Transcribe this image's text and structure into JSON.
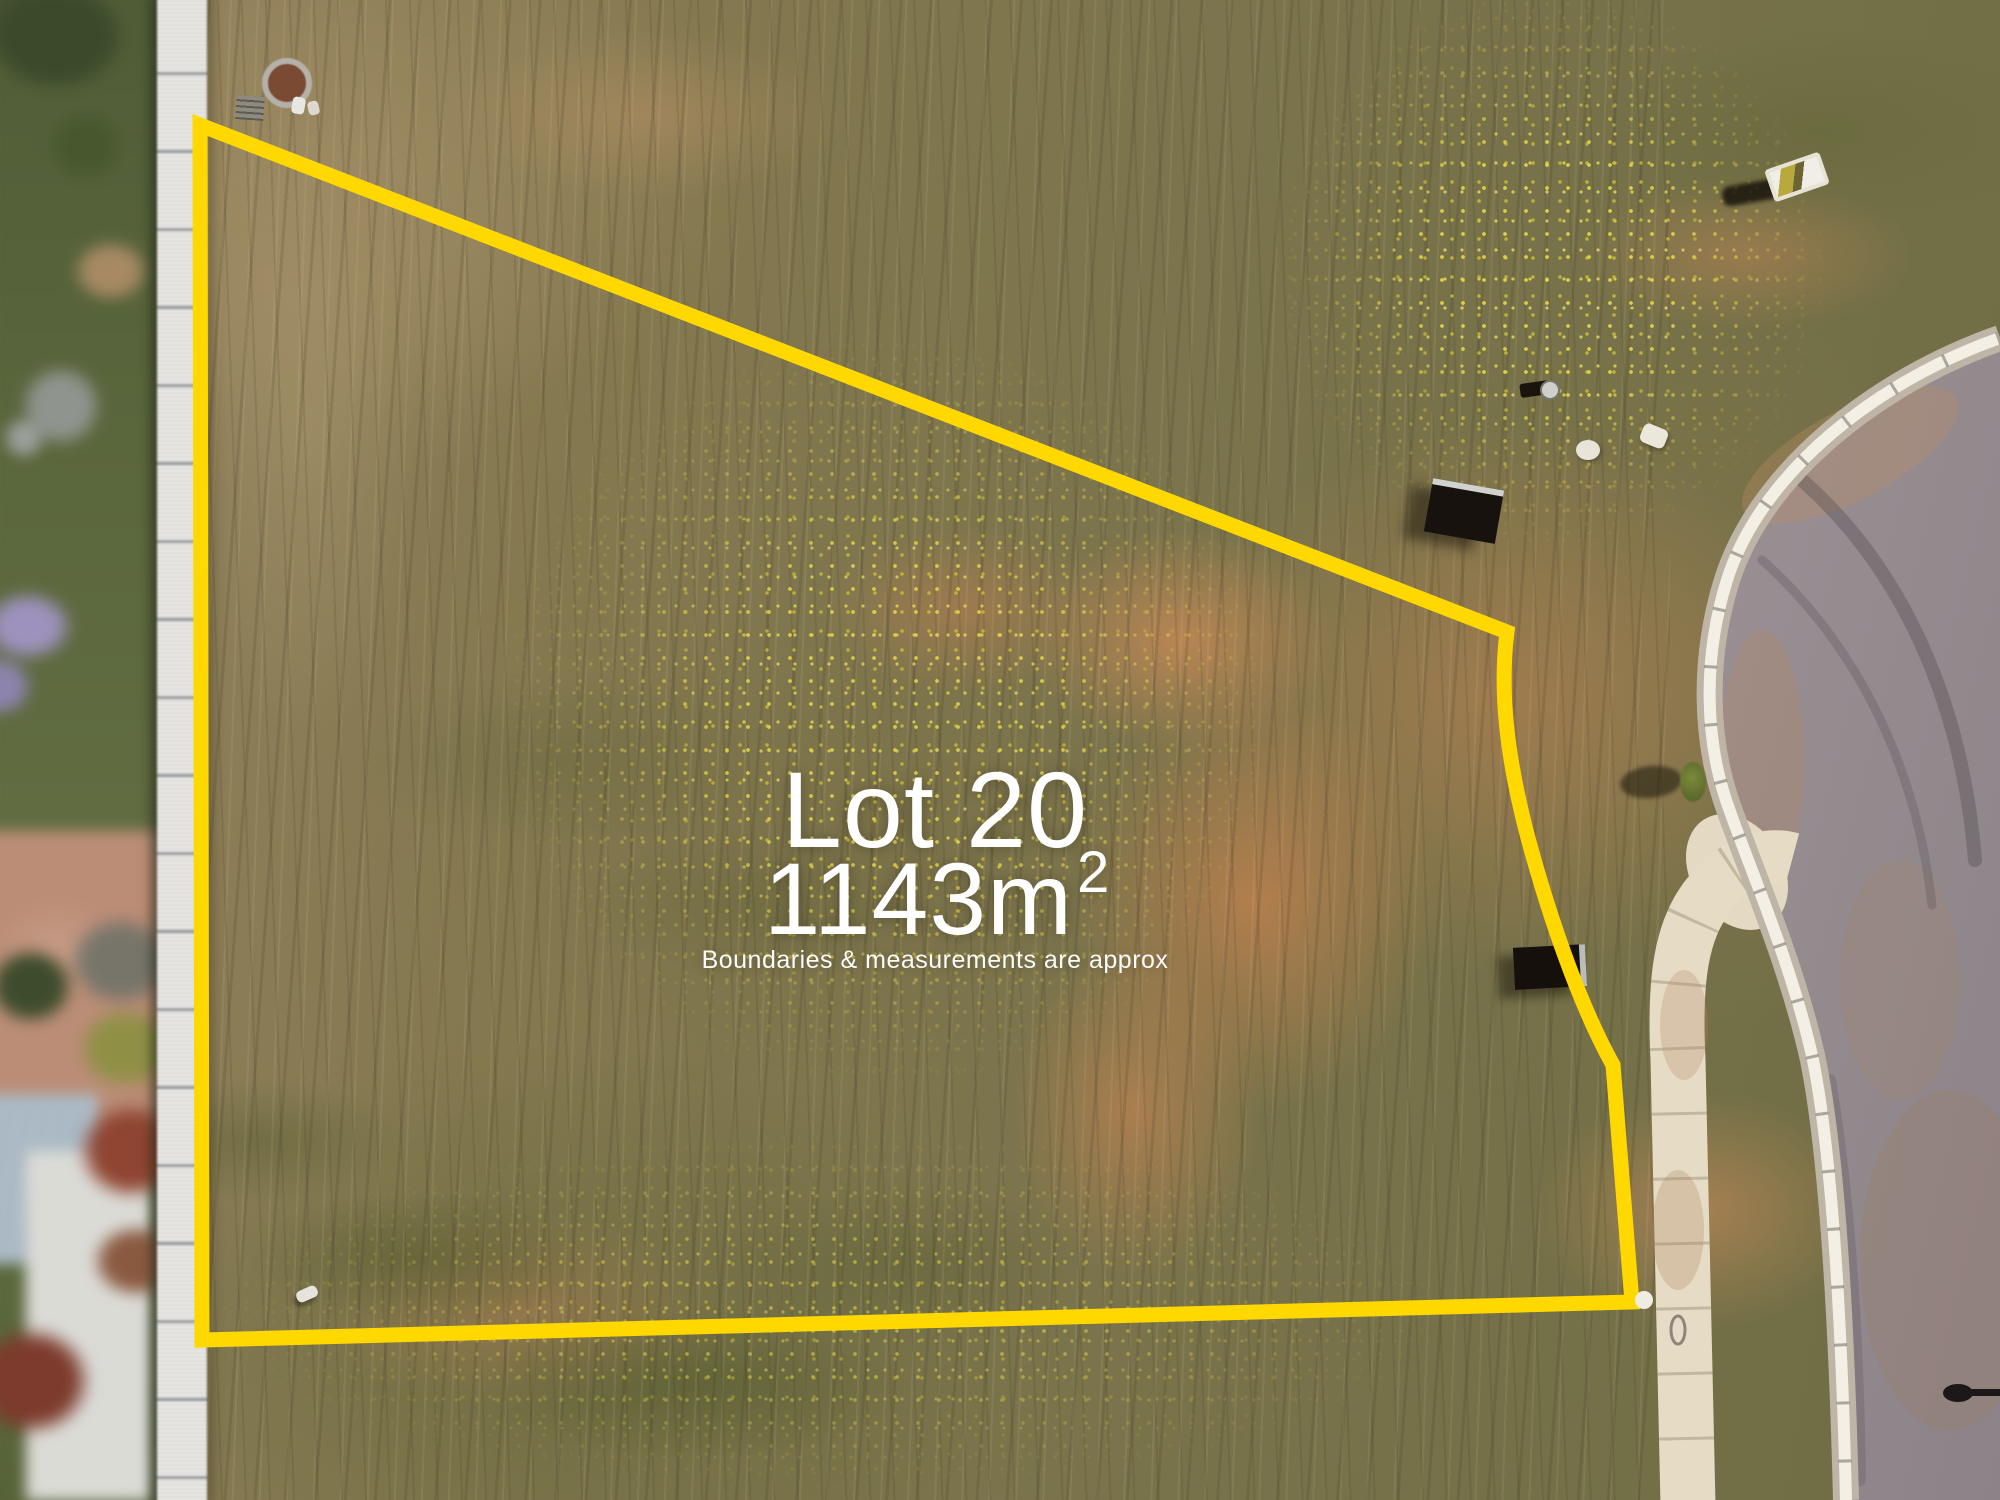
{
  "overlay": {
    "lot_label": "Lot 20",
    "area_value": "1143m",
    "area_exponent": "2",
    "disclaimer": "Boundaries & measurements are approx",
    "text_color": "#ffffff",
    "boundary_color": "#ffd800"
  },
  "scene": {
    "type": "aerial-drone-photo",
    "features": [
      "vacant grass lot with mowing rows and yellow wildflowers",
      "yellow surveyed boundary outline",
      "neighbouring backyard and long white fence on left",
      "orange dirt patches",
      "concrete footpath and kerb",
      "asphalt cul-de-sac road on right",
      "survey pegs and sale sign boards"
    ]
  }
}
